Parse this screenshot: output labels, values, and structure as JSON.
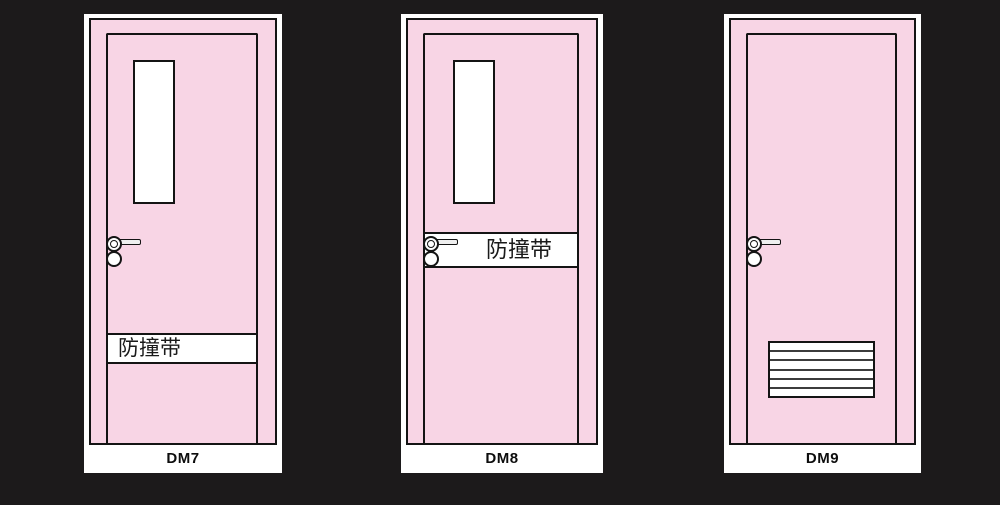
{
  "scene": {
    "background_color": "#1c1a1b"
  },
  "colors": {
    "door_fill": "#f8d5e5",
    "frame_fill": "#ffffff",
    "outline": "#141414"
  },
  "doors": [
    {
      "model_label": "DM7",
      "band_text": "防撞带",
      "has_vision_panel": true,
      "has_louver": false
    },
    {
      "model_label": "DM8",
      "band_text": "防撞带",
      "has_vision_panel": true,
      "has_louver": false
    },
    {
      "model_label": "DM9",
      "band_text": "",
      "has_vision_panel": false,
      "has_louver": true
    }
  ]
}
